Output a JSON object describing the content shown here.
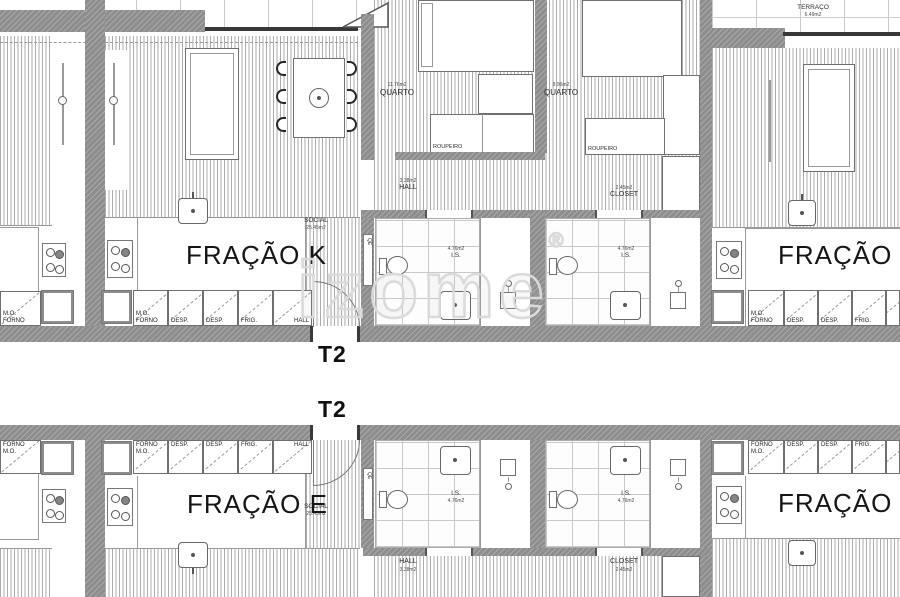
{
  "unit_type": "T2",
  "watermark": {
    "text": "izome",
    "reg": "®"
  },
  "units": {
    "k": "FRAÇÃO K",
    "l": "FRAÇÃO L",
    "e": "FRAÇÃO E",
    "f": "FRAÇÃO F"
  },
  "rooms": {
    "social": {
      "name": "SOCIAL",
      "area": "25.45m2"
    },
    "quarto_1": {
      "name": "QUARTO",
      "area": "11.76m2"
    },
    "quarto_2": {
      "name": "QUARTO",
      "area": "8.96m2"
    },
    "hall": {
      "name": "HALL",
      "area": "3.38m2"
    },
    "closet": {
      "name": "CLOSET",
      "area": "2.45m2"
    },
    "wc": {
      "name": "I.S.",
      "area": "4.76m2"
    },
    "terrace": {
      "name": "TERRAÇO",
      "area": "6.49m2"
    },
    "roupeiro": {
      "name": "ROUPEIRO"
    }
  },
  "kitchen": {
    "mo": "M.O.",
    "forno": "FORNO",
    "desp": "DESP.",
    "frig": "FRIG.",
    "hall": "HALL"
  },
  "door_code": "QE"
}
